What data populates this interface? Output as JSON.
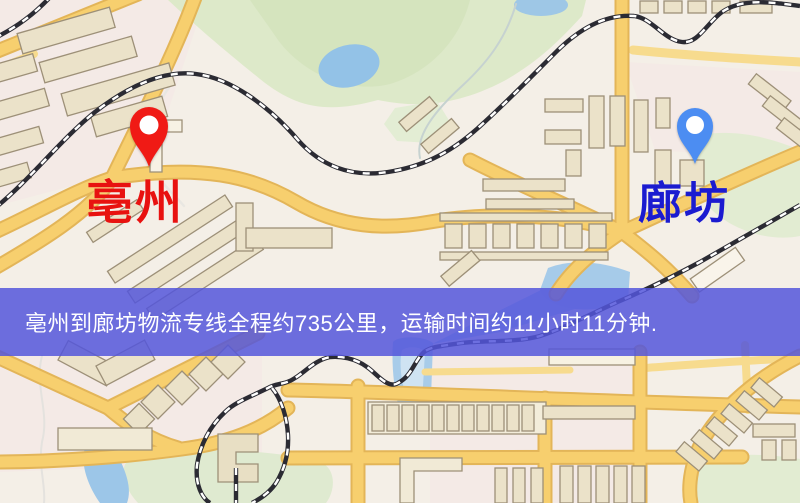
{
  "map": {
    "origin": {
      "label": "亳州",
      "pin_color": "#f01a15",
      "label_color": "#e81210"
    },
    "destination": {
      "label": "廊坊",
      "pin_color": "#4c8df2",
      "label_color": "#1b1bd0"
    }
  },
  "banner": {
    "text": "亳州到廊坊物流专线全程约735公里，运输时间约11小时11分钟.",
    "background_color": "#5456da",
    "text_color": "#ffffff"
  },
  "map_colors": {
    "land": "#f4efe7",
    "road_fill": "#f7cf6e",
    "road_casing": "#e3b558",
    "park_green": "#dde9c9",
    "water_blue": "#93c2e7",
    "building_fill": "#ebe2c9",
    "building_stroke": "#9d9078",
    "railway_dark": "#2b2b33"
  }
}
